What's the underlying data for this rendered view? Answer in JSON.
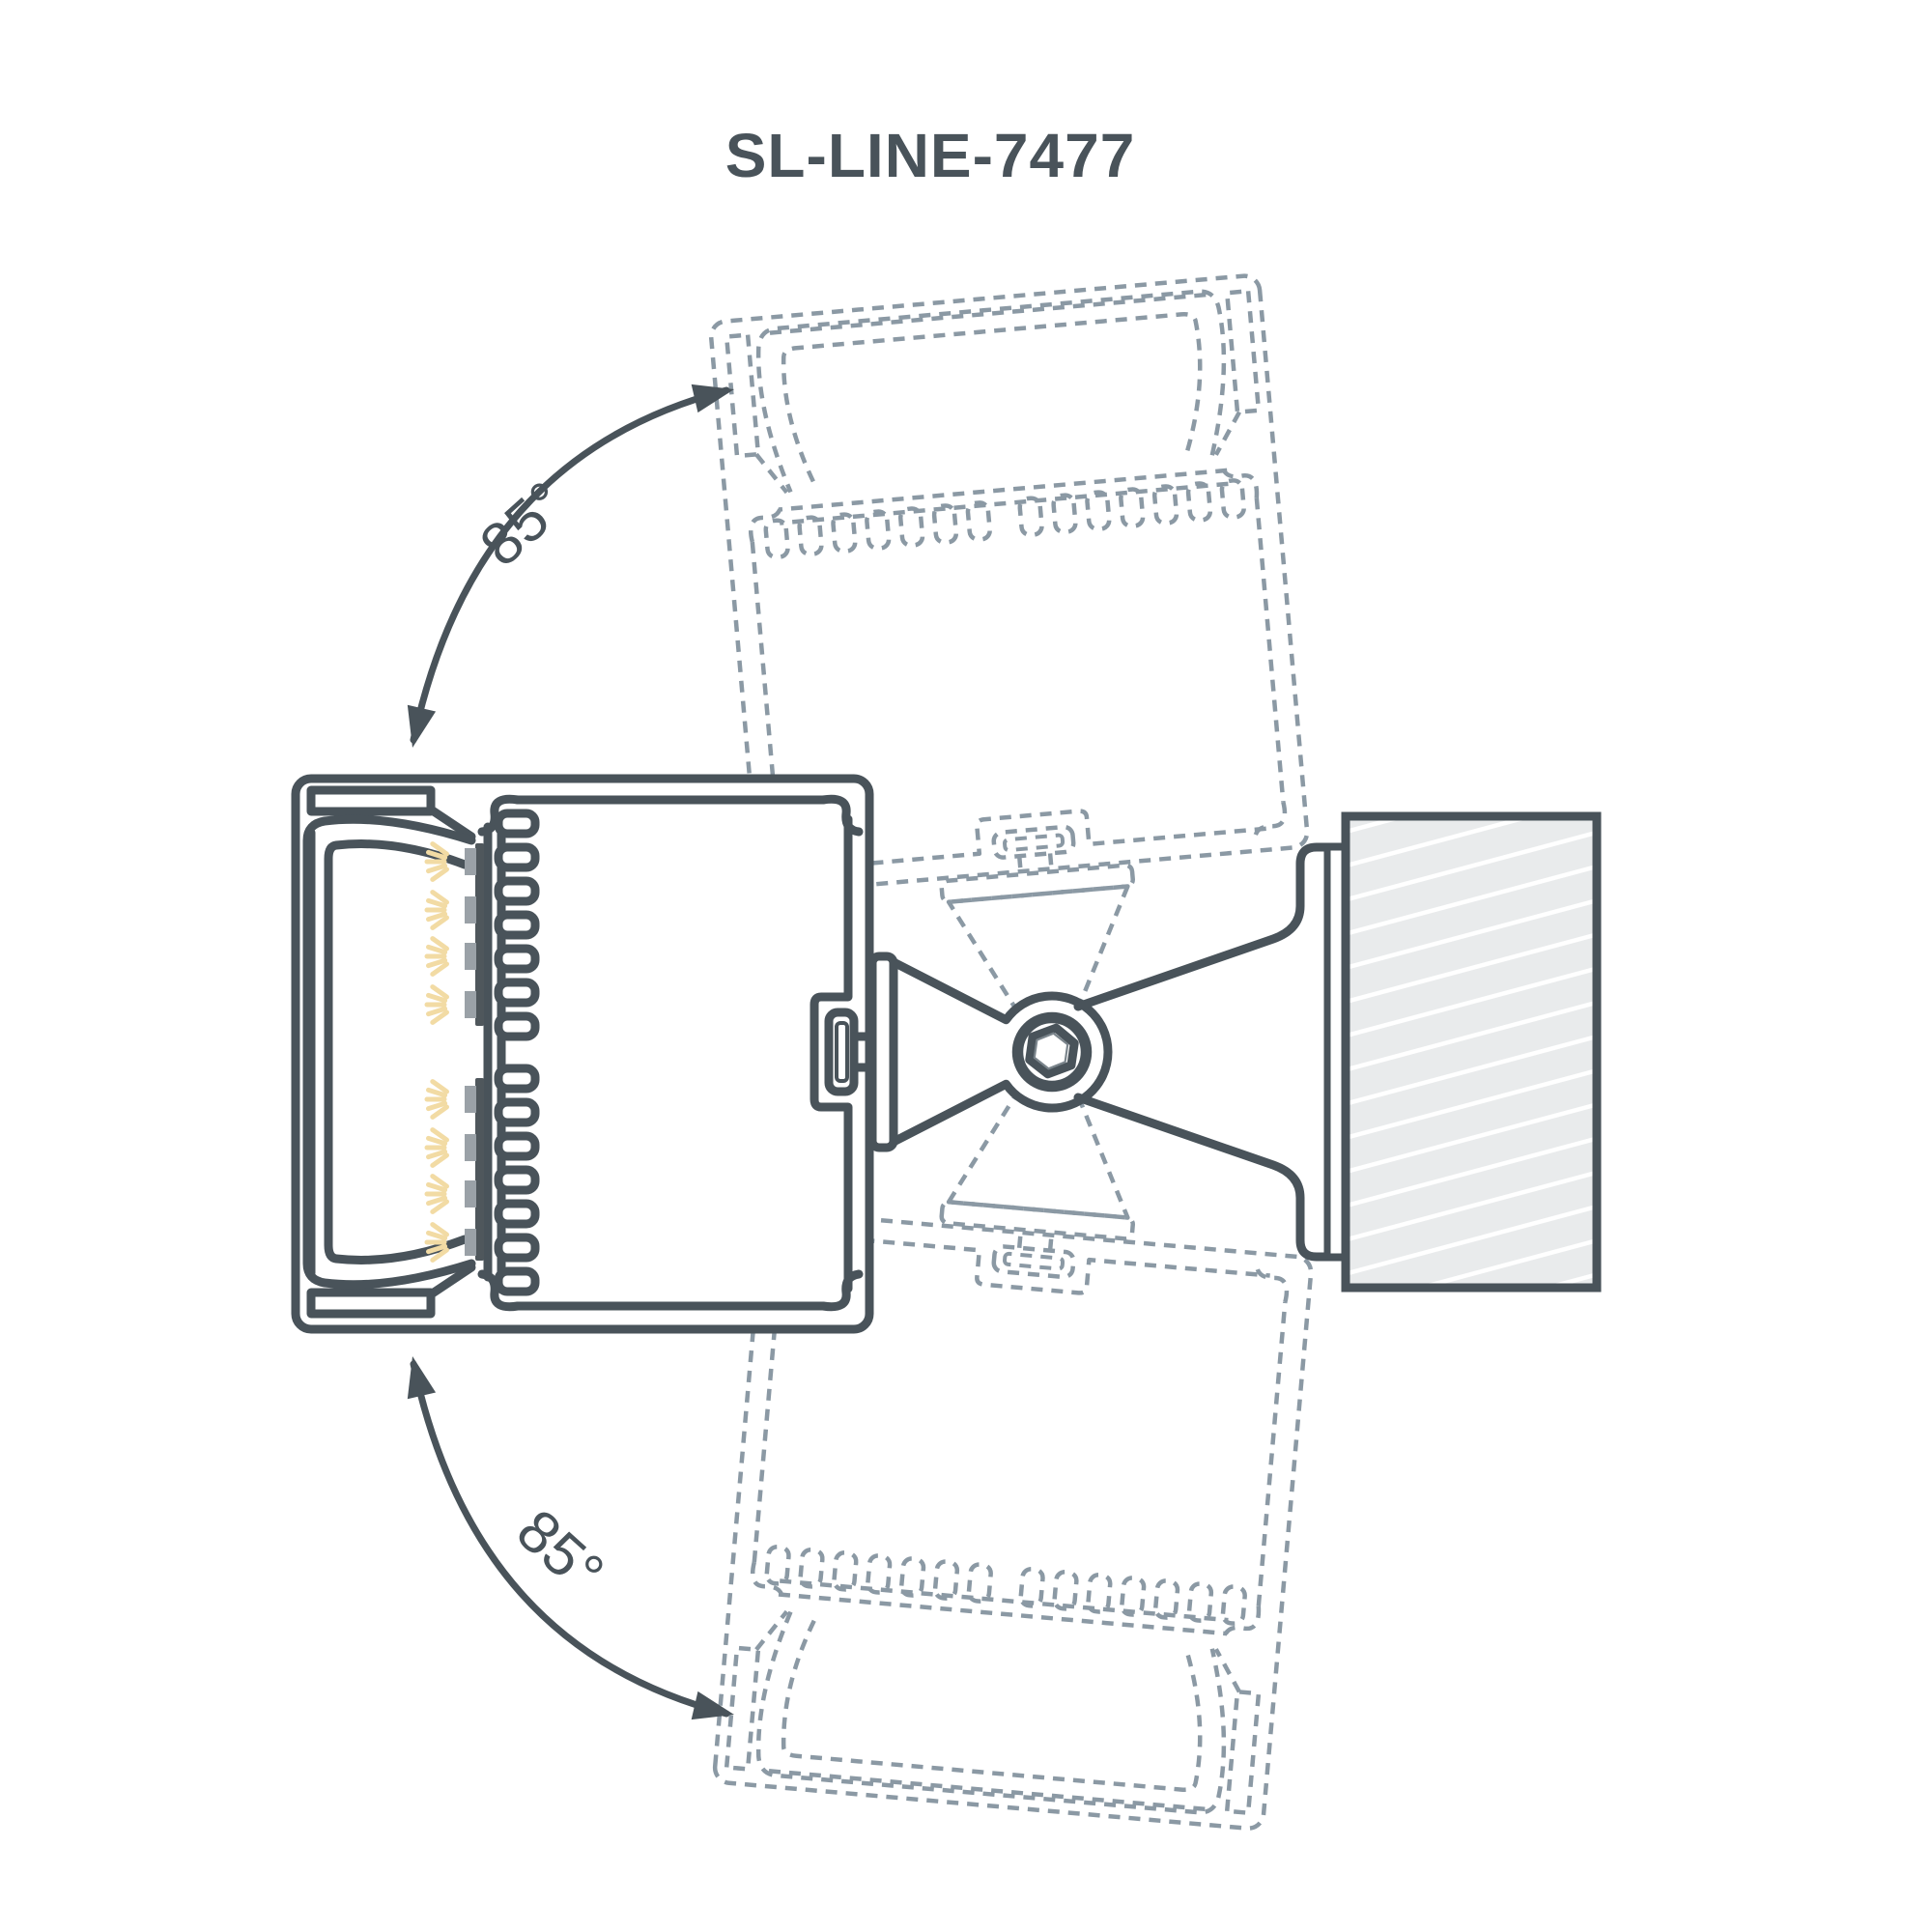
{
  "title": "SL-LINE-7477",
  "angles": {
    "top_label": "85°",
    "bottom_label": "85°"
  },
  "colors": {
    "line": "#49535a",
    "ghost_dash": "#8b99a4",
    "text": "#49535a",
    "wall_fill": "#e9ebec",
    "wall_hatch": "#ffffff",
    "led_ray": "#f2dba4",
    "led_pad": "#9aa1a7",
    "led_bar": "#4f575c",
    "background": "#ffffff"
  },
  "parts": {
    "fixture": "linear-luminaire-cross-section",
    "heatsink": "finned-heatsink",
    "led_modules": "led-strips-with-light-rays",
    "diffuser": "lens-diffuser",
    "latch": "cover-latch-clip",
    "bracket": "adjustable-mounting-bracket",
    "screw": "hex-socket-pivot-screw",
    "wall": "hatched-mounting-surface",
    "ghosts": "rotated-position-outlines",
    "arrows": "rotation-range-arrows"
  }
}
